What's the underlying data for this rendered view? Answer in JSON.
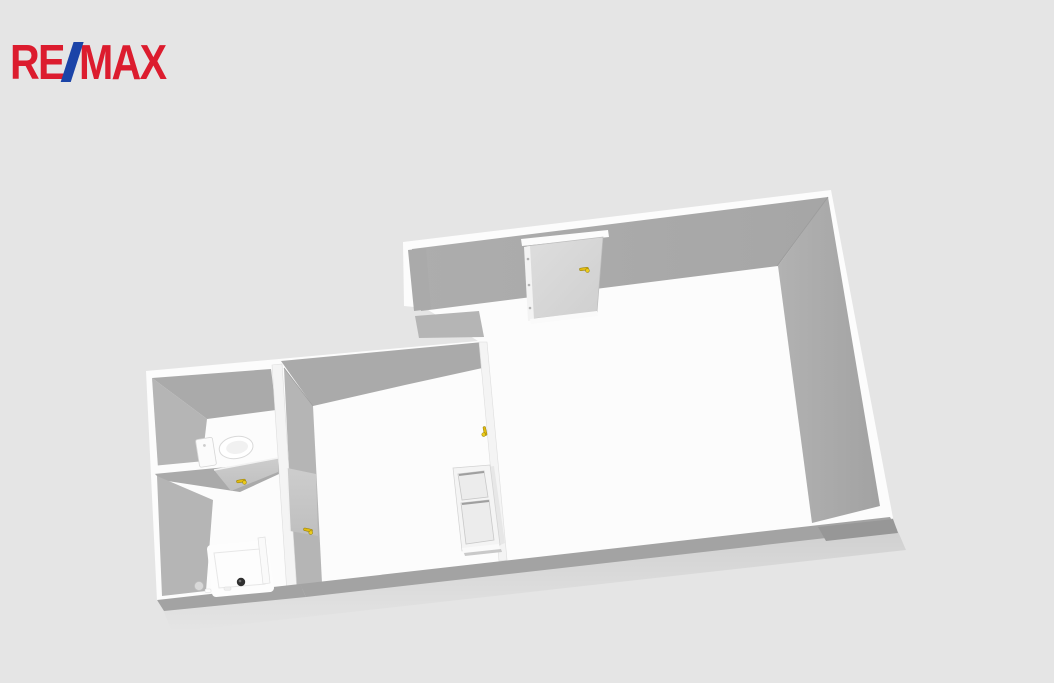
{
  "logo": {
    "re": "RE",
    "slash": "/",
    "max": "MAX"
  },
  "scene": {
    "description": "3D bird's-eye floor plan render of a one-bedroom apartment on a light gray background",
    "colors": {
      "bg": "#e5e5e5",
      "trim": "#fcfcfc",
      "wall": "#aaaaaa",
      "wall-light": "#b5b5b5",
      "wall-dark": "#979797",
      "south-band": "#a3a3a3",
      "strip": "#f4f4f4",
      "floor": "#ffffff",
      "door": "#d9d9d9",
      "door-leaf": "#c9c9c9",
      "appliance": "#f2f2f2",
      "appliance-panel": "#ebebeb",
      "handle": "#e2bb10",
      "handle-edge": "#8f7a00",
      "drain": "#303030",
      "remax-red": "#dc1c2e",
      "remax-blue": "#1b44a8"
    },
    "rooms": [
      {
        "name": "living-room"
      },
      {
        "name": "kitchen"
      },
      {
        "name": "wc"
      },
      {
        "name": "bathroom"
      }
    ],
    "fixtures": [
      {
        "name": "entry-door"
      },
      {
        "name": "fridge"
      },
      {
        "name": "toilet"
      },
      {
        "name": "shower-tray"
      },
      {
        "name": "shower-screen"
      },
      {
        "name": "wc-door"
      },
      {
        "name": "bathroom-door"
      }
    ],
    "handles": [
      {
        "x": 584,
        "y": 269,
        "r": -8
      },
      {
        "x": 485,
        "y": 431,
        "r": 78
      },
      {
        "x": 241,
        "y": 481,
        "r": -10
      },
      {
        "x": 308,
        "y": 530,
        "r": 12
      }
    ]
  }
}
